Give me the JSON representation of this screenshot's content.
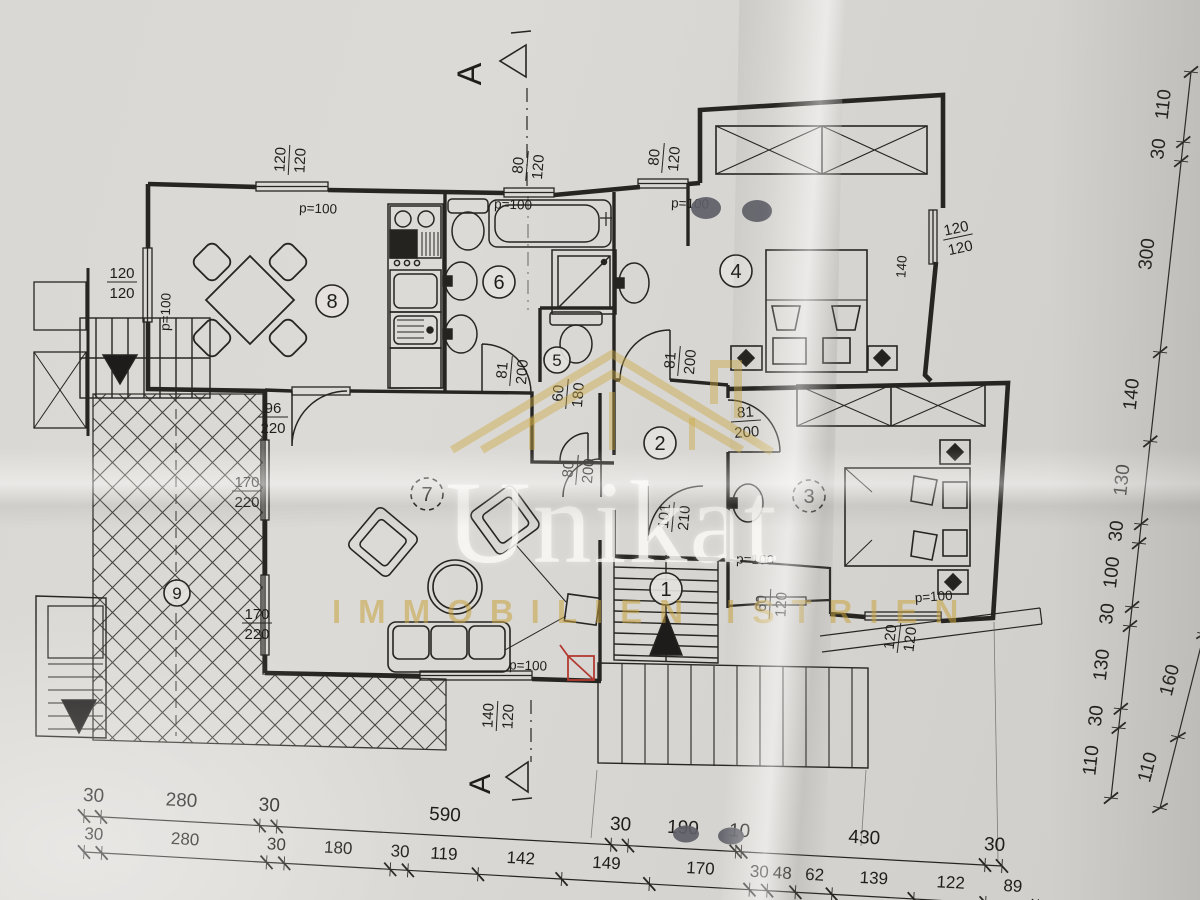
{
  "watermark": {
    "brand": "Unikat",
    "tagline": "IMMOBILIEN ISTRIEN",
    "brand_color": "#c7a23e",
    "text_color": "rgba(250,249,245,0.80)"
  },
  "plan": {
    "ink_color": "#262522",
    "paper_color": "#d9d7d3",
    "accent_red": "#b23a32",
    "rooms": [
      {
        "n": "1",
        "x": 666,
        "y": 589
      },
      {
        "n": "2",
        "x": 660,
        "y": 443
      },
      {
        "n": "3",
        "x": 809,
        "y": 496,
        "dash": true
      },
      {
        "n": "4",
        "x": 736,
        "y": 271
      },
      {
        "n": "5",
        "x": 557,
        "y": 360,
        "r": 13
      },
      {
        "n": "6",
        "x": 499,
        "y": 282
      },
      {
        "n": "7",
        "x": 427,
        "y": 494,
        "dash": true
      },
      {
        "n": "8",
        "x": 332,
        "y": 301
      },
      {
        "n": "9",
        "x": 177,
        "y": 593,
        "r": 13
      }
    ],
    "pairs": [
      {
        "a": "120",
        "b": "120",
        "x": 289,
        "y": 160,
        "r": -87
      },
      {
        "a": "120",
        "b": "120",
        "x": 122,
        "y": 282,
        "r": 0
      },
      {
        "a": "80",
        "b": "120",
        "x": 527,
        "y": 166,
        "r": -85
      },
      {
        "a": "80",
        "b": "120",
        "x": 663,
        "y": 158,
        "r": -85
      },
      {
        "a": "120",
        "b": "120",
        "x": 958,
        "y": 237,
        "r": -12
      },
      {
        "a": "140",
        "b": "120",
        "x": 497,
        "y": 716,
        "r": -87
      },
      {
        "a": "120",
        "b": "120",
        "x": 899,
        "y": 638,
        "r": -83
      },
      {
        "a": "60",
        "b": "120",
        "x": 770,
        "y": 604,
        "r": -87
      },
      {
        "a": "170",
        "b": "220",
        "x": 247,
        "y": 491,
        "r": 0
      },
      {
        "a": "170",
        "b": "220",
        "x": 257,
        "y": 623,
        "r": 0
      },
      {
        "a": "96",
        "b": "220",
        "x": 273,
        "y": 417,
        "r": 0
      },
      {
        "a": "81",
        "b": "200",
        "x": 679,
        "y": 361,
        "r": -85
      },
      {
        "a": "81",
        "b": "200",
        "x": 746,
        "y": 421,
        "r": -4
      },
      {
        "a": "81",
        "b": "200",
        "x": 511,
        "y": 371,
        "r": -85
      },
      {
        "a": "101",
        "b": "210",
        "x": 673,
        "y": 517,
        "r": -85
      },
      {
        "a": "60",
        "b": "180",
        "x": 567,
        "y": 394,
        "r": -85
      },
      {
        "a": "80",
        "b": "200",
        "x": 577,
        "y": 470,
        "r": -85
      }
    ],
    "texts": [
      {
        "t": "p=100",
        "x": 318,
        "y": 213,
        "r": 2
      },
      {
        "t": "p=100",
        "x": 513,
        "y": 209,
        "r": 2
      },
      {
        "t": "p=100",
        "x": 690,
        "y": 208,
        "r": 2
      },
      {
        "t": "p=100",
        "x": 170,
        "y": 312,
        "r": -88
      },
      {
        "t": "p=100",
        "x": 755,
        "y": 564,
        "r": 2
      },
      {
        "t": "p=100",
        "x": 934,
        "y": 601,
        "r": -4
      },
      {
        "t": "p=100",
        "x": 528,
        "y": 670,
        "r": 2
      },
      {
        "t": "140",
        "x": 906,
        "y": 267,
        "r": -86
      },
      {
        "t": "A",
        "x": 481,
        "y": 74,
        "r": -90,
        "s": 34
      },
      {
        "t": "A",
        "x": 490,
        "y": 784,
        "r": -90,
        "s": 30
      }
    ],
    "dim_chains": [
      {
        "id": "bottom-upper",
        "x1": 84,
        "y1": 816,
        "x2": 1002,
        "y2": 866,
        "side": 1,
        "off": 15,
        "fs": 19,
        "values": [
          30,
          280,
          30,
          590,
          30,
          190,
          10,
          430,
          30
        ]
      },
      {
        "id": "bottom-lower",
        "x1": 84,
        "y1": 852,
        "x2": 1038,
        "y2": 906,
        "side": 1,
        "off": 13,
        "fs": 17,
        "values": [
          30,
          280,
          30,
          180,
          30,
          119,
          142,
          149,
          170,
          30,
          48,
          62,
          139,
          122,
          89
        ]
      },
      {
        "id": "right-outer",
        "x1": 1191,
        "y1": 72,
        "x2": 1111,
        "y2": 798,
        "side": -1,
        "off": 18,
        "fs": 19,
        "values": [
          110,
          30,
          300,
          140,
          130,
          30,
          100,
          30,
          130,
          30,
          110
        ]
      },
      {
        "id": "right-inner",
        "x1": 1204,
        "y1": 634,
        "x2": 1160,
        "y2": 808,
        "side": -1,
        "off": 16,
        "fs": 19,
        "values": [
          160,
          110
        ]
      }
    ]
  }
}
